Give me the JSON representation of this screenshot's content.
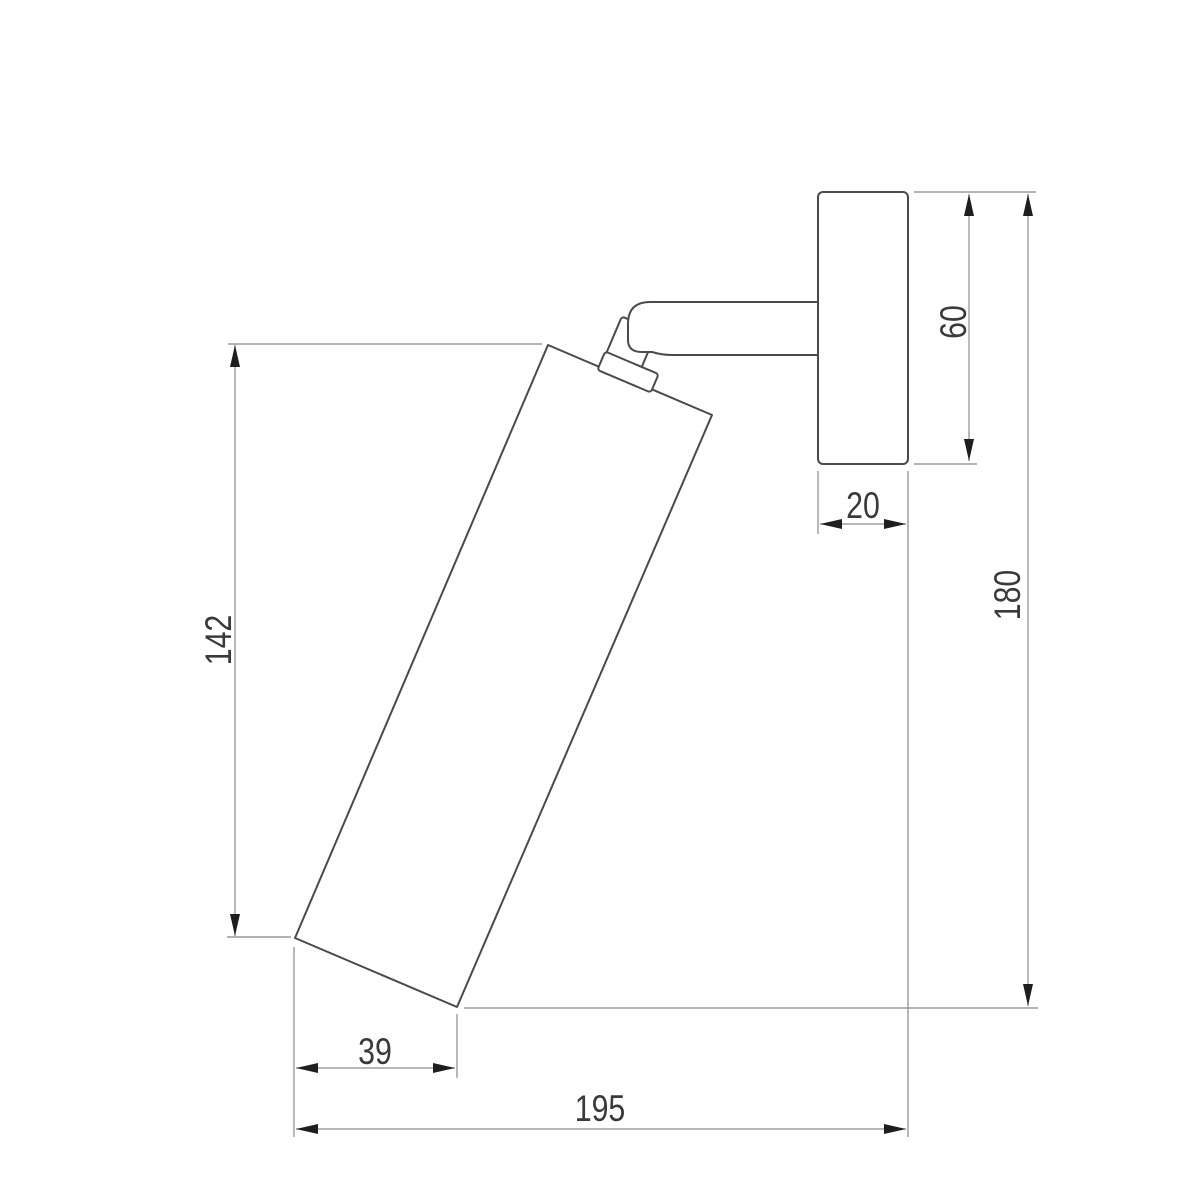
{
  "diagram": {
    "dimension_labels": {
      "body_length": "142",
      "body_width": "39",
      "total_projection": "195",
      "plate_thickness": "20",
      "plate_height": "60",
      "overall_height": "180"
    }
  },
  "colors": {
    "background": "#ffffff",
    "object_line": "#4a4a4a",
    "dimension_line": "#8c8c8c",
    "extension_line": "#9a9a9a",
    "arrow": "#1e1e1e",
    "label_text": "#3a3a3a"
  }
}
